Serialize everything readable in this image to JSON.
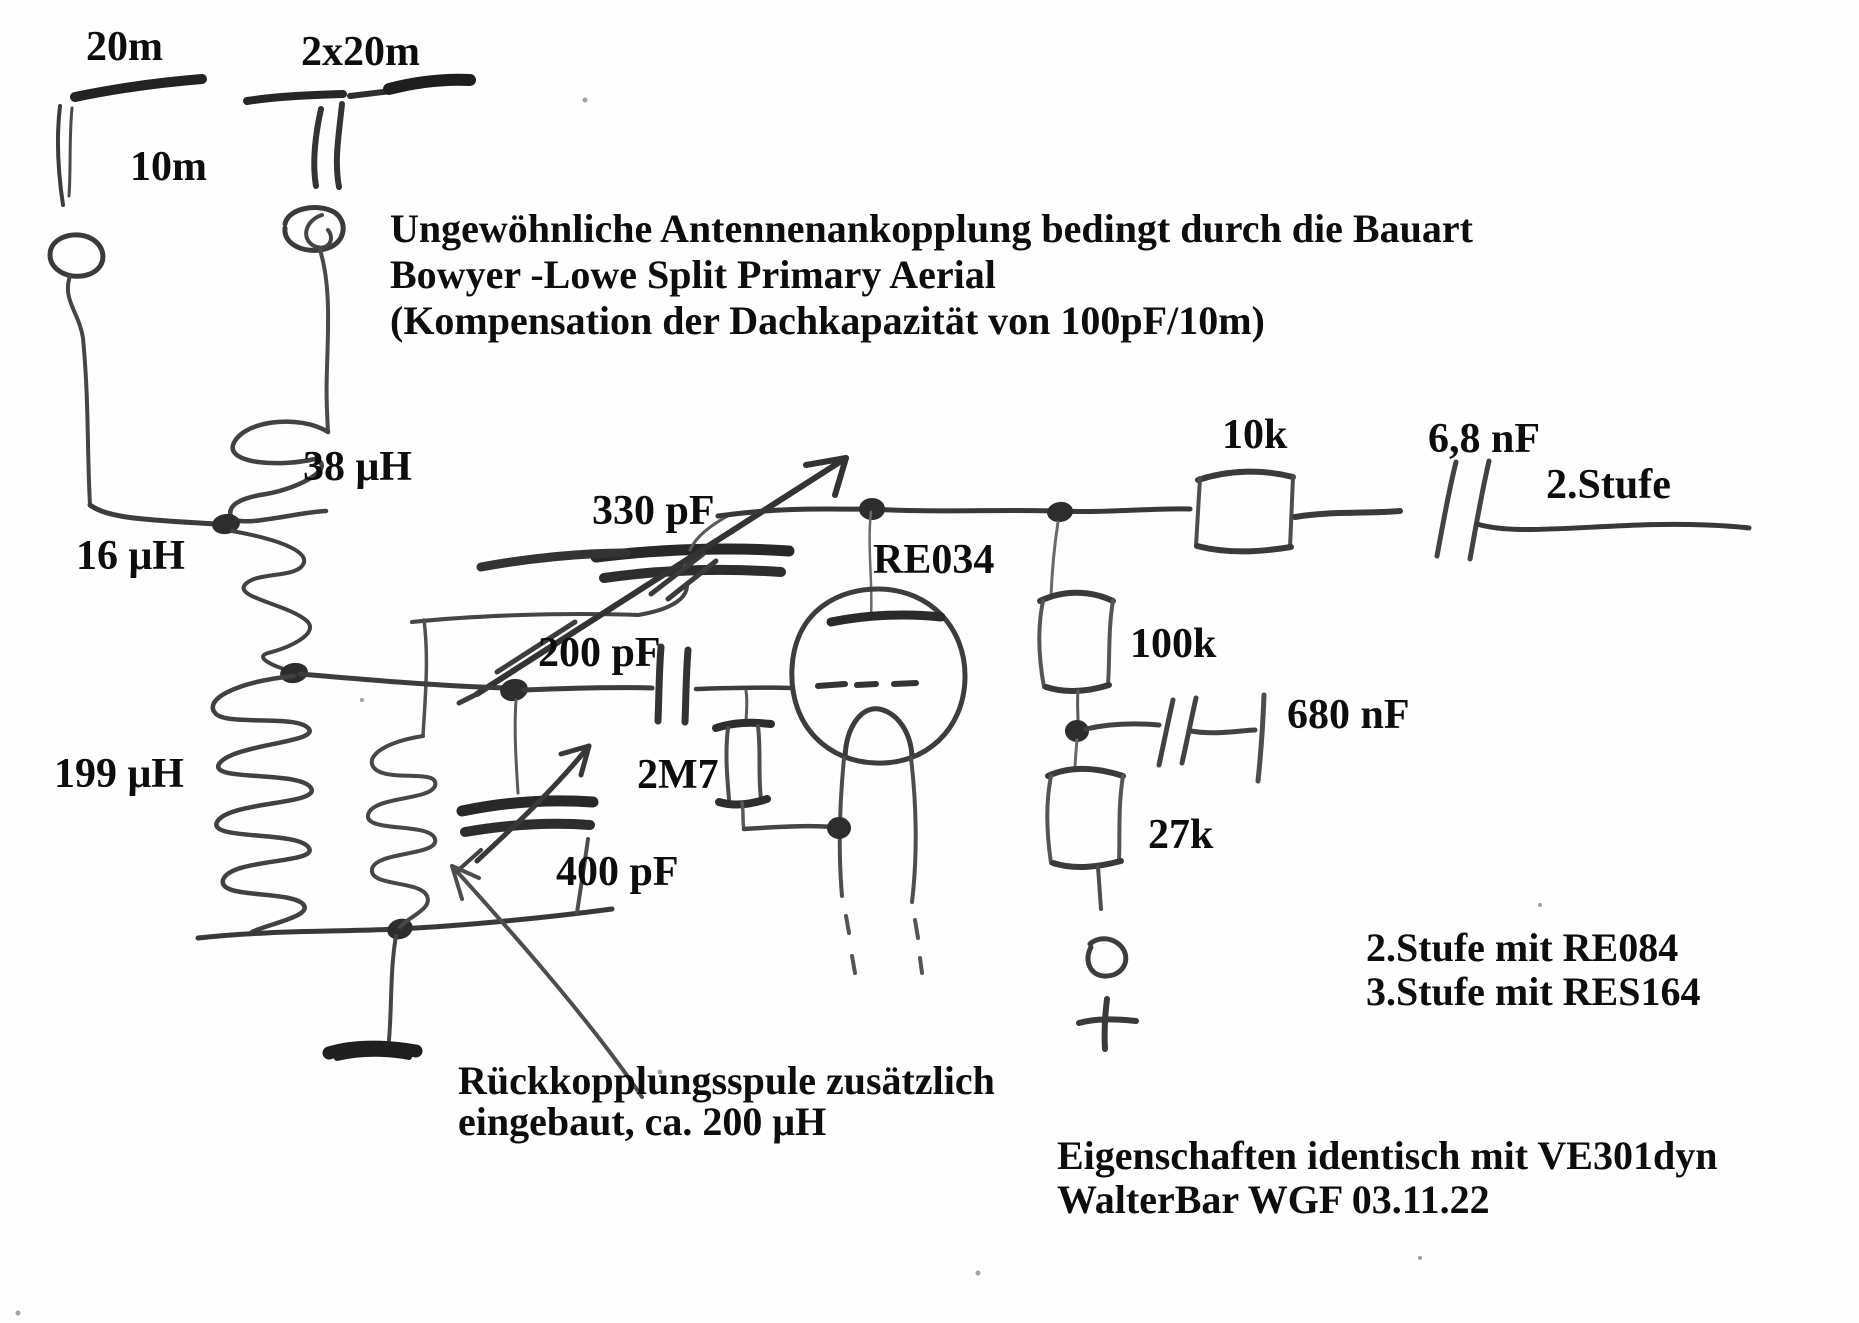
{
  "page": {
    "background_color": "#fefefe",
    "printed_ink_color": "#0d0d0d",
    "pencil_color": "#3f3f3f"
  },
  "antennas": {
    "left_length": "20m",
    "right_length": "2x20m",
    "height_label": "10m"
  },
  "title": {
    "line1": "Ungewöhnliche Antennenankopplung bedingt durch die Bauart",
    "line2": "Bowyer -Lowe Split Primary Aerial",
    "line3": "(Kompensation der Dachkapazität von 100pF/10m)"
  },
  "components": {
    "coil_antenna_upper": "38 μH",
    "coil_antenna_lower": "16 μH",
    "coil_tank": "199 μH",
    "cap_feedback": "330 pF",
    "cap_grid": "200 pF",
    "cap_tuning": "400 pF",
    "res_grid_leak": "2M7",
    "tube": "RE034",
    "res_anode": "10k",
    "cap_coupling": "6,8 nF",
    "stage_output": "2.Stufe",
    "res_100k": "100k",
    "cap_bypass": "680 nF",
    "res_bias": "27k"
  },
  "notes": {
    "feedback_line1": "Rückkopplungsspule zusätzlich",
    "feedback_line2": "eingebaut, ca. 200 μH",
    "stage2": "2.Stufe mit RE084",
    "stage3": "3.Stufe mit RES164",
    "properties": "Eigenschaften identisch mit VE301dyn",
    "signature": "WalterBar WGF 03.11.22"
  }
}
